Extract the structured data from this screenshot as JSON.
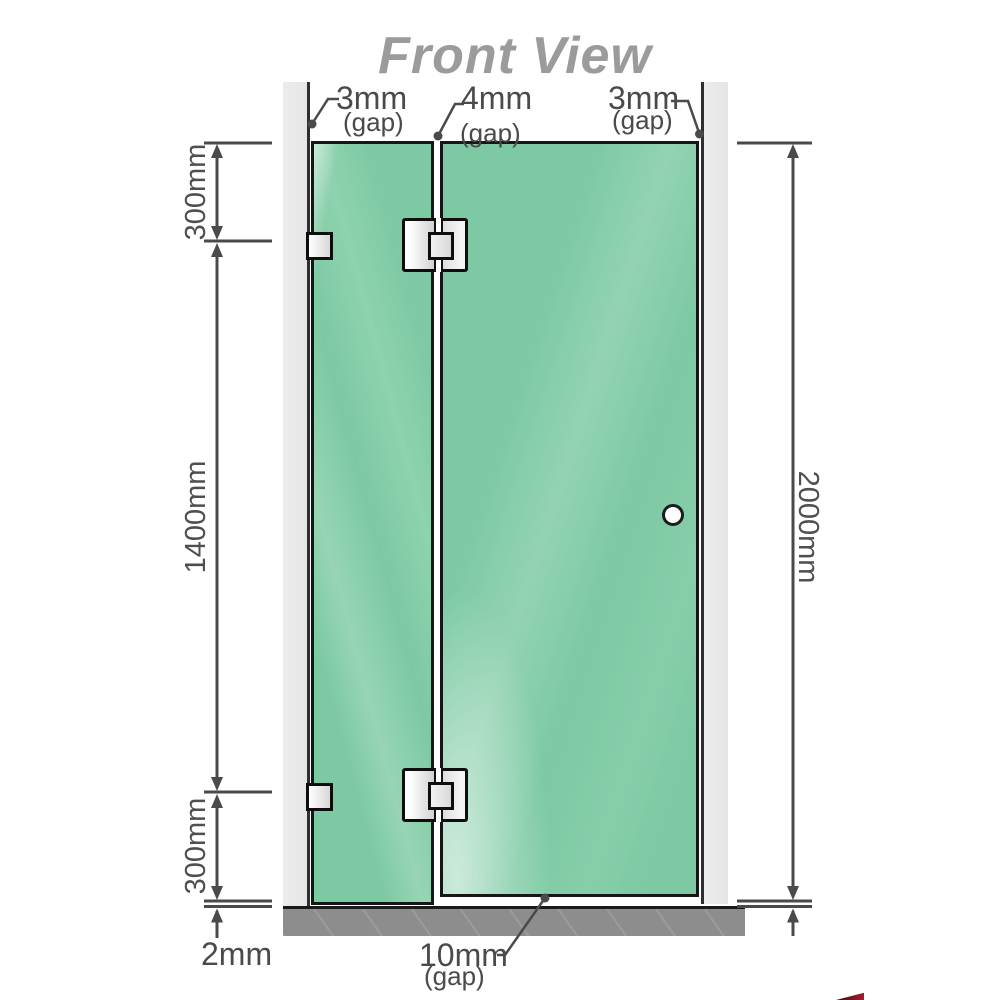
{
  "title": "Front View",
  "annotations": {
    "gap_top_left": {
      "value": "3mm",
      "qualifier": "(gap)"
    },
    "gap_top_middle": {
      "value": "4mm",
      "qualifier": "(gap)"
    },
    "gap_top_right": {
      "value": "3mm",
      "qualifier": "(gap)"
    },
    "gap_bottom_door": {
      "value": "10mm",
      "qualifier": "(gap)"
    },
    "floor_gap": "2mm"
  },
  "dimensions": {
    "top_segment": "300mm",
    "middle_segment": "1400mm",
    "bottom_segment": "300mm",
    "total_height": "2000mm"
  },
  "colors": {
    "glass_green": "#7cc9a3",
    "wall_gray": "#e9e9e9",
    "floor_gray": "#8d8d8d",
    "dimension_line": "#4a4a4a",
    "title_gray": "#9b9b9b",
    "logo_red": "#a21f2f"
  }
}
